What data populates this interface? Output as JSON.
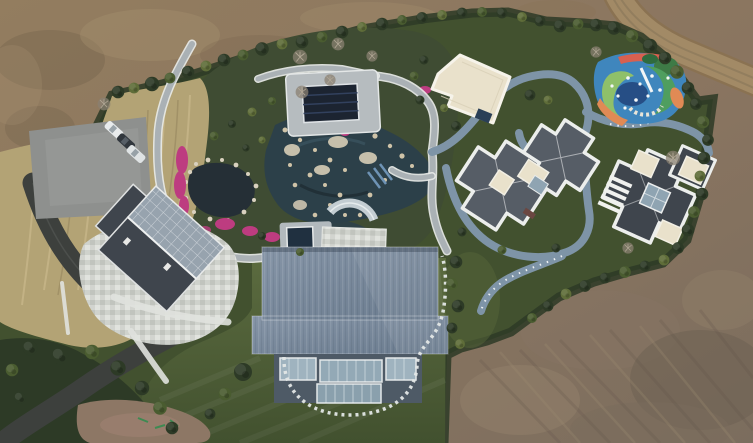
{
  "image": {
    "type": "aerial-drone-photograph",
    "alt": "Top-down aerial photo of a luxury landscaped estate under construction: bare brown earth surrounds a green compound containing a pond garden with magenta azaleas, a navy covered pool, a large blue-ribbed-roof hall, a stone patio house, two slate-roofed villas, a cream pavilion, a colourful playground, a winding blue-grey track, a parking pad with three cars and a curving asphalt driveway.",
    "width_px": 753,
    "height_px": 443
  },
  "palette": {
    "dirt_base": "#8a7560",
    "dirt_dark": "#6d5c4a",
    "dirt_light": "#a38c69",
    "grass_dark": "#2d3a26",
    "grass_mid": "#42512f",
    "tree_olive": "#5f6d39",
    "tree_green": "#4a5c30",
    "lawn": "#55663a",
    "lawn_deep": "#43522f",
    "dry_grass": "#b3a375",
    "water_dark": "#252f36",
    "water_teal": "#2c4049",
    "path_light": "#cdd1d3",
    "track_blue": "#7e94a7",
    "asphalt": "#3d403d",
    "concrete": "#8e908e",
    "roof_blue": "#76869a",
    "roof_slate": "#565d66",
    "roof_dark": "#3f454d",
    "glass_blue": "#93a6b4",
    "parapet_white": "#eceeec",
    "cream": "#e9e1cb",
    "flower_pink": "#bd3c80",
    "rock_tan": "#d7cdb6",
    "navy_pool": "#1c2431",
    "pg_blue": "#3f86bd",
    "pg_navy": "#24487e",
    "pg_green": "#4f9e5f",
    "pg_lime": "#8fc06a",
    "pg_orange": "#e08a55",
    "pg_coral": "#d86050",
    "dirt_road": "#a28a66"
  },
  "scene": {
    "regions": [
      {
        "name": "surrounding-earthworks",
        "label": "Bare graded earth surrounding the estate"
      },
      {
        "name": "dirt-track-road",
        "label": "Dirt vehicle track along the north-east corner"
      },
      {
        "name": "estate-grounds",
        "label": "Hedged estate with lawns and winding paths"
      },
      {
        "name": "parking-area",
        "label": "Concrete parking pad with three parked cars"
      },
      {
        "name": "driveway",
        "label": "Asphalt driveway curving to the south-west corner"
      },
      {
        "name": "dry-meadow",
        "label": "Dry tawny grass bank on the west side"
      },
      {
        "name": "stone-patio",
        "label": "Mottled stone-paved courtyard"
      },
      {
        "name": "west-house",
        "label": "Gabled house, half dark roof, half glass conservatory"
      },
      {
        "name": "koi-pond",
        "label": "Dark pond ringed by rocks and magenta azaleas"
      },
      {
        "name": "rock-garden",
        "label": "Rockery water garden with cascades and stone paths"
      },
      {
        "name": "covered-pool",
        "label": "Navy rectangular pool cover with deck"
      },
      {
        "name": "main-hall",
        "label": "Barn-style hall, ribbed blue-grey roof, glass curtain wall"
      },
      {
        "name": "stepping-path",
        "label": "Stepping-stone loop around the main hall"
      },
      {
        "name": "east-villa-1",
        "label": "Villa with cross-shaped slate hip roofs edged white"
      },
      {
        "name": "east-villa-2",
        "label": "Villa with pinwheel slate roof, cream terraces, skylight"
      },
      {
        "name": "roof-pavilion",
        "label": "Cream flat-roofed pavilion"
      },
      {
        "name": "playground",
        "label": "Multicoloured children's playground with slide"
      },
      {
        "name": "jogging-track",
        "label": "Blue-grey track winding between villas and playground"
      },
      {
        "name": "south-lawn",
        "label": "Mown lawn with specimen trees"
      },
      {
        "name": "graded-patch",
        "label": "Re-graded soil patch with green survey marks"
      }
    ],
    "vehicles": {
      "count": 3,
      "colors": [
        "white",
        "dark-grey",
        "silver"
      ]
    }
  }
}
